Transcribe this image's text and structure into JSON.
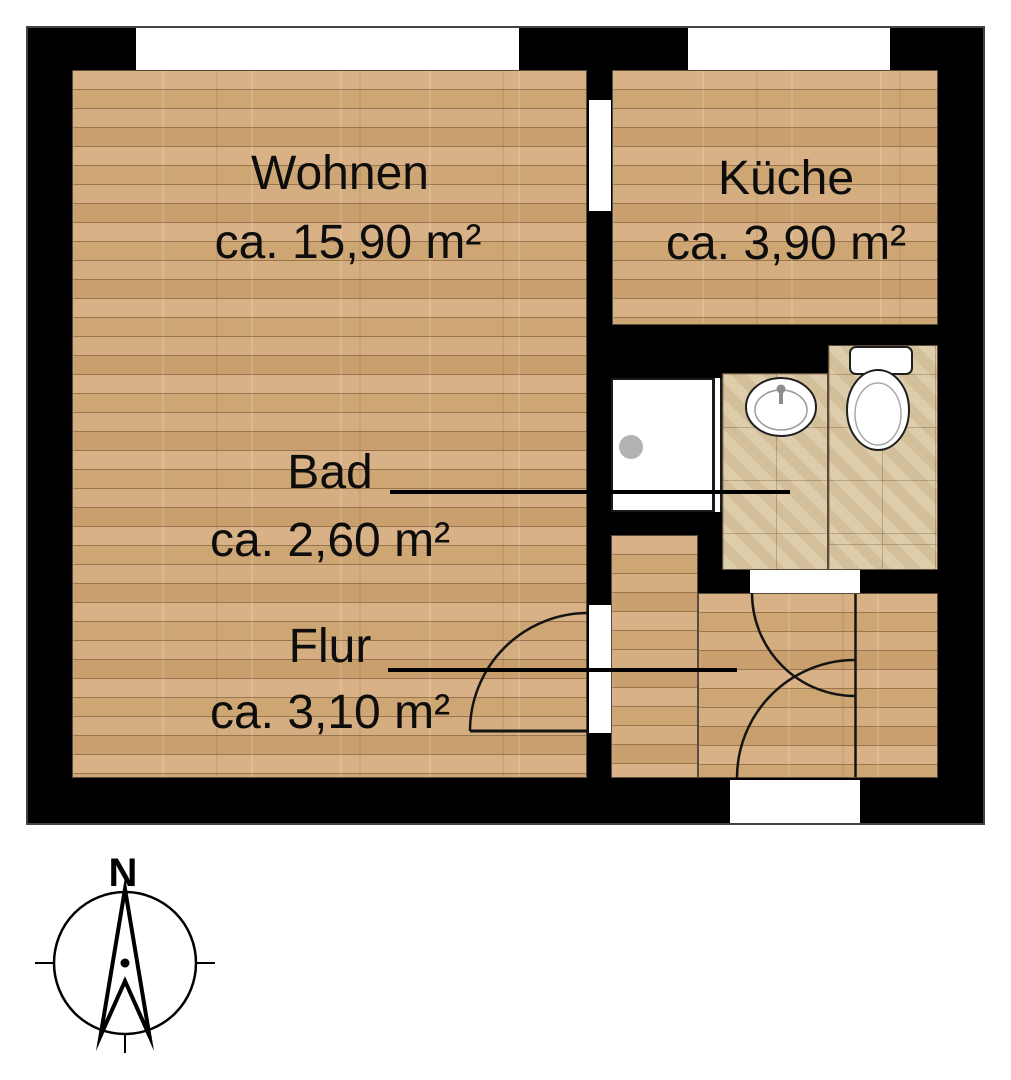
{
  "plan": {
    "rooms": [
      {
        "name": "Wohnen",
        "area": "ca. 15,90 m²"
      },
      {
        "name": "Küche",
        "area": "ca. 3,90 m²"
      },
      {
        "name": "Bad",
        "area": "ca. 2,60 m²"
      },
      {
        "name": "Flur",
        "area": "ca. 3,10 m²"
      }
    ],
    "fixtures": [
      "shower",
      "sink",
      "toilet"
    ],
    "compass": {
      "north_label": "N"
    },
    "colors": {
      "wall": "#000000",
      "wood_floor": "#d2ab7d",
      "tile_floor": "#d9c7a2",
      "outline": "#434343",
      "background": "#ffffff"
    }
  }
}
